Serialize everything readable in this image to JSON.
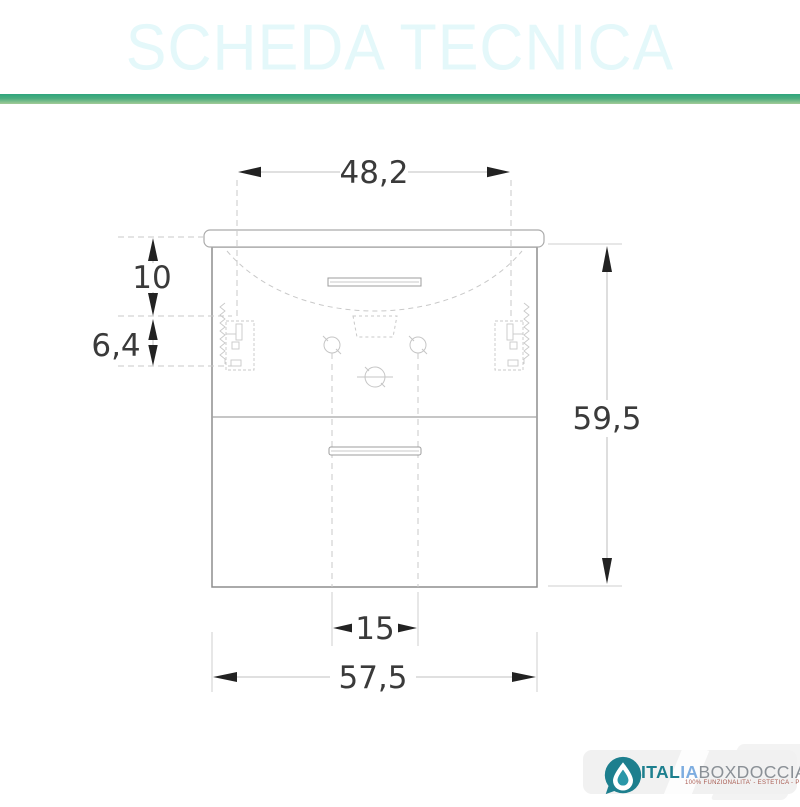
{
  "header": {
    "title": "SCHEDA TECNICA",
    "colors": {
      "background": "#2BA3D7",
      "text": "#E4F8FA",
      "strip_top": "#2FA57D",
      "strip_bottom": "#A3CB97"
    }
  },
  "drawing": {
    "dimensions": {
      "top_width": "48,2",
      "basin_height": "10",
      "bracket_offset": "6,4",
      "total_height": "59,5",
      "drain_spacing": "15",
      "total_width": "57,5"
    },
    "colors": {
      "outline": "#8d8d8d",
      "construction": "#c9c9c9",
      "arrow": "#222222",
      "label": "#3a3a3a"
    }
  },
  "logo": {
    "icon": "water-drop-icon",
    "brand_primary": "ITAL",
    "brand_secondary": "IA",
    "brand_rest": "BOXDOCCIA",
    "tagline": "100% FUNZIONALITA' - ESTETICA - PRATICITA'",
    "colors": {
      "teal": "#1D7F8E",
      "light_blue": "#7DADE0",
      "gray": "#8A9096",
      "tagline": "#A85A50"
    }
  }
}
